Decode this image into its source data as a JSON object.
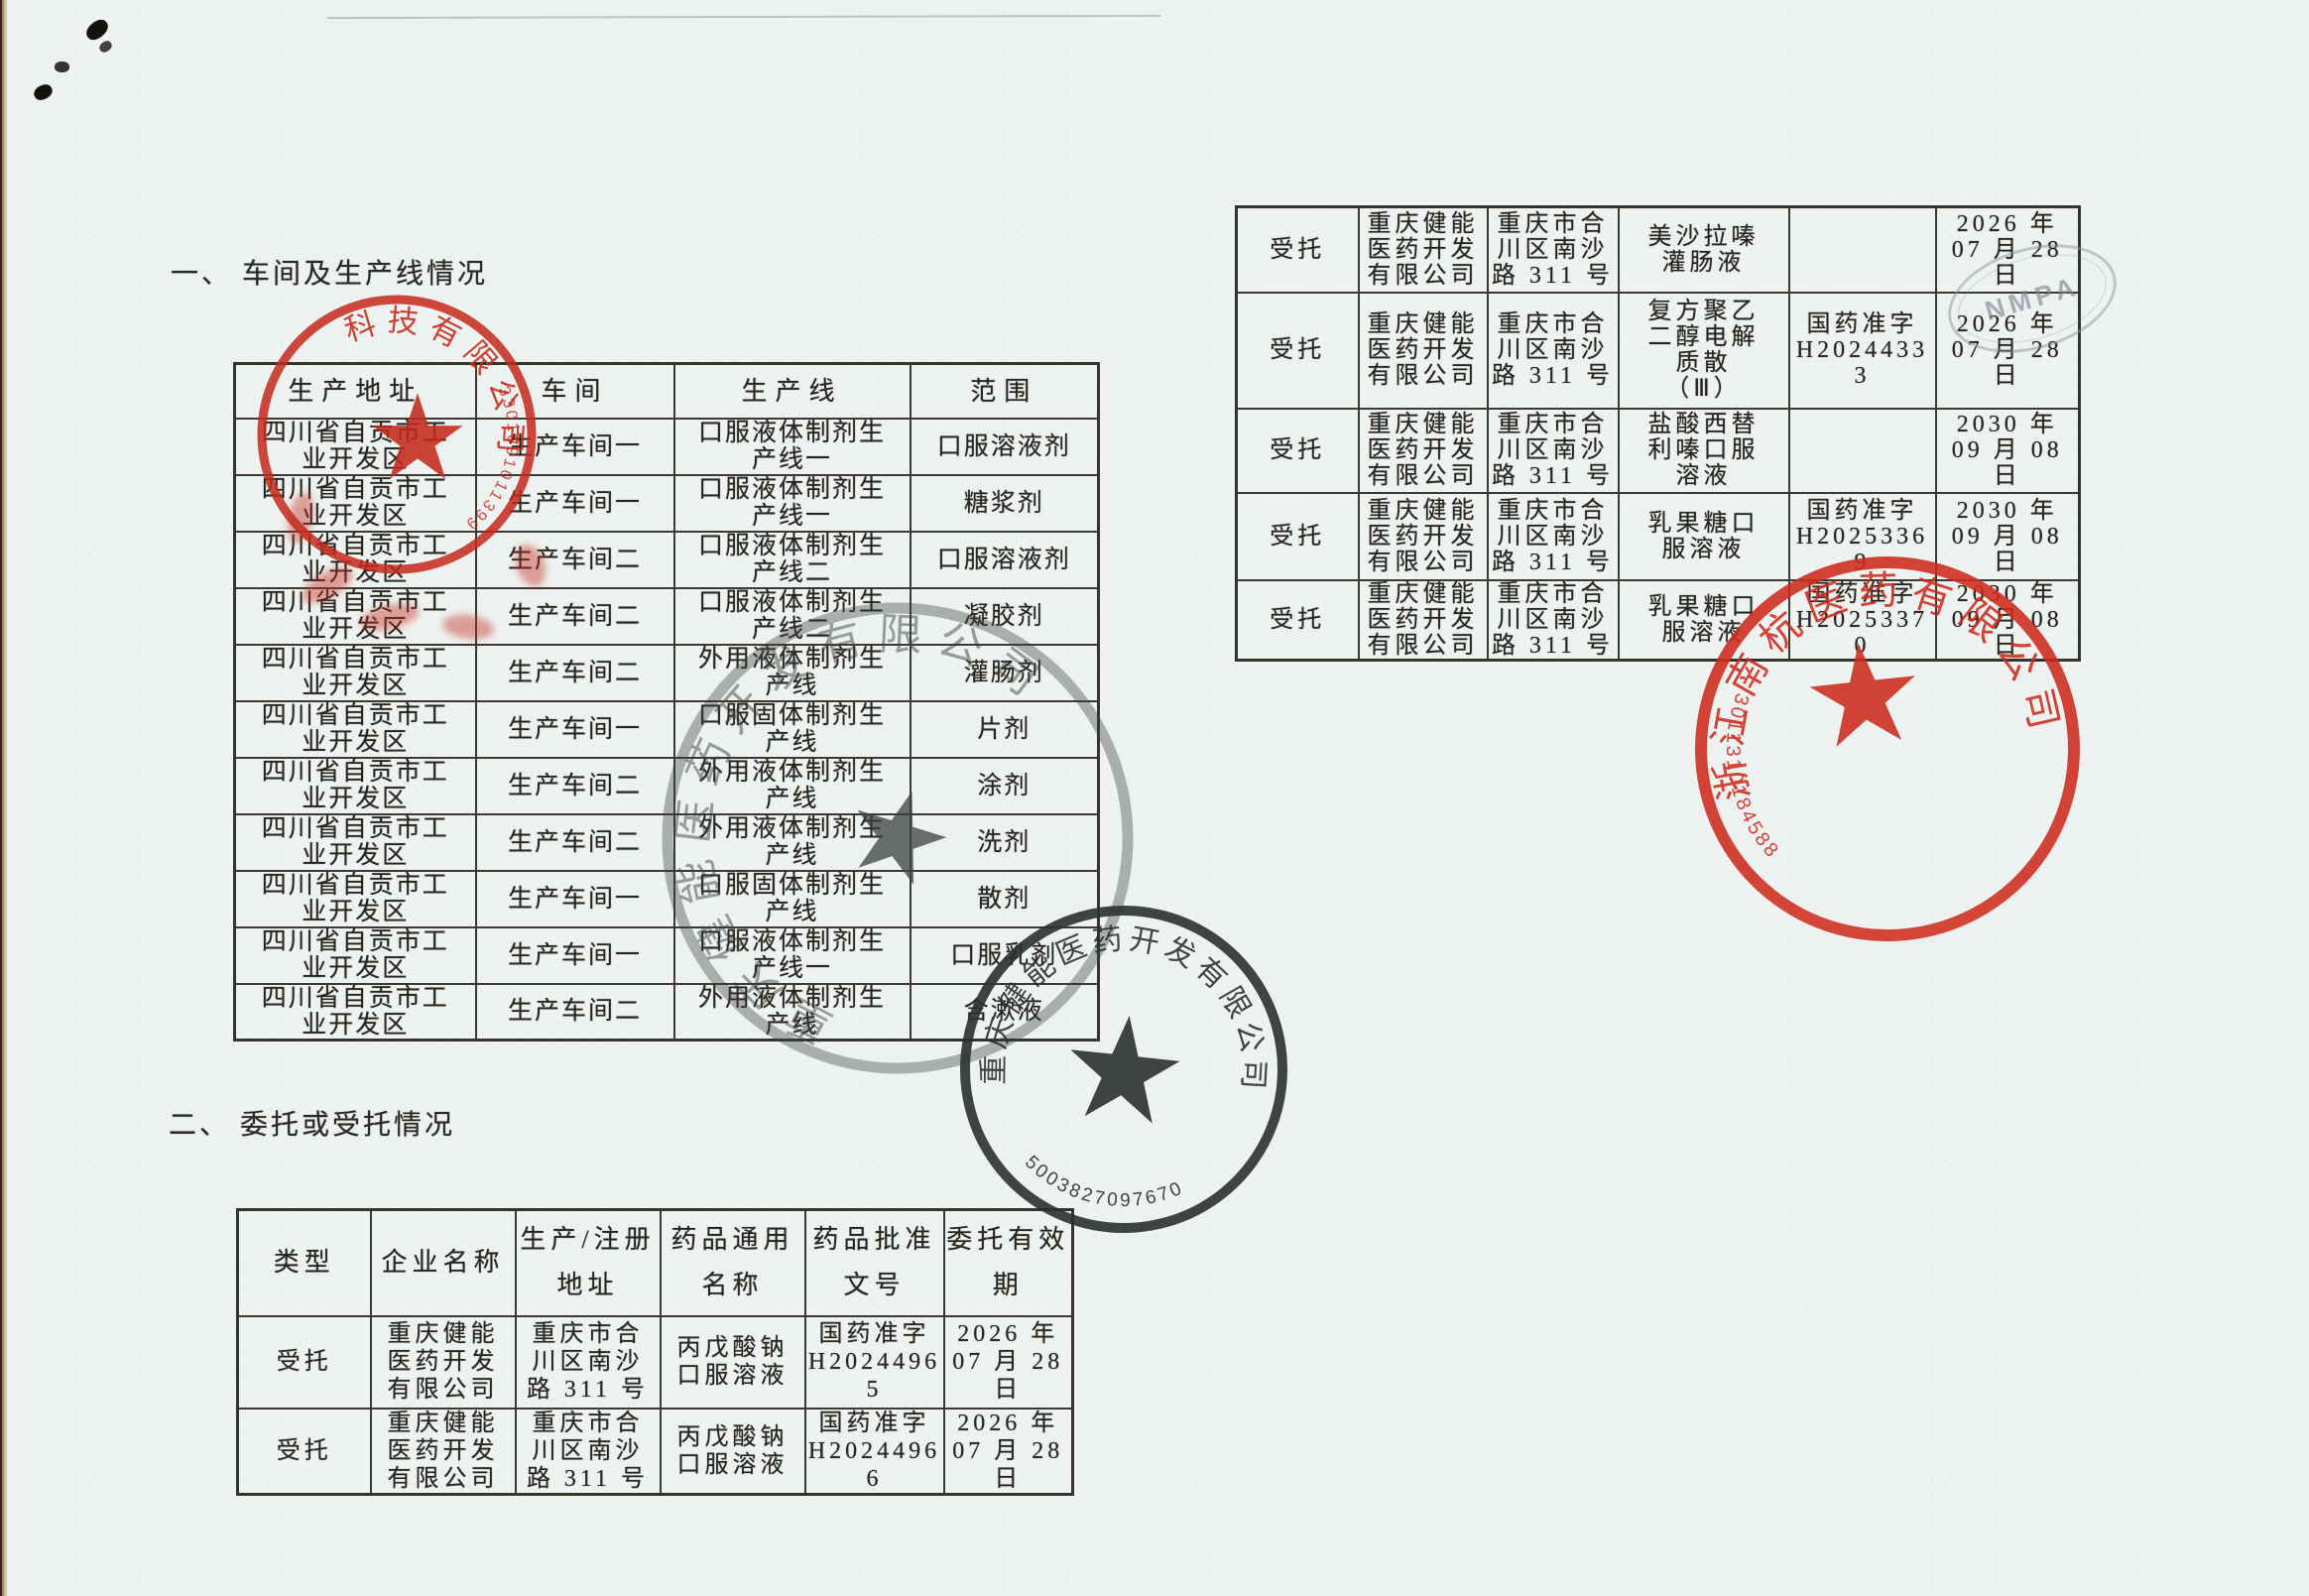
{
  "page": {
    "heading1": "一、 车间及生产线情况",
    "heading2": "二、 委托或受托情况"
  },
  "table1": {
    "headers": [
      "生产地址",
      "车间",
      "生产线",
      "范围"
    ],
    "rows": [
      [
        "四川省自贡市工\n业开发区",
        "生产车间一",
        "口服液体制剂生\n产线一",
        "口服溶液剂"
      ],
      [
        "四川省自贡市工\n业开发区",
        "生产车间一",
        "口服液体制剂生\n产线一",
        "糖浆剂"
      ],
      [
        "四川省自贡市工\n业开发区",
        "生产车间二",
        "口服液体制剂生\n产线二",
        "口服溶液剂"
      ],
      [
        "四川省自贡市工\n业开发区",
        "生产车间二",
        "口服液体制剂生\n产线二",
        "凝胶剂"
      ],
      [
        "四川省自贡市工\n业开发区",
        "生产车间二",
        "外用液体制剂生\n产线",
        "灌肠剂"
      ],
      [
        "四川省自贡市工\n业开发区",
        "生产车间一",
        "口服固体制剂生\n产线",
        "片剂"
      ],
      [
        "四川省自贡市工\n业开发区",
        "生产车间二",
        "外用液体制剂生\n产线",
        "涂剂"
      ],
      [
        "四川省自贡市工\n业开发区",
        "生产车间二",
        "外用液体制剂生\n产线",
        "洗剂"
      ],
      [
        "四川省自贡市工\n业开发区",
        "生产车间一",
        "口服固体制剂生\n产线",
        "散剂"
      ],
      [
        "四川省自贡市工\n业开发区",
        "生产车间一",
        "口服液体制剂生\n产线一",
        "口服乳剂"
      ],
      [
        "四川省自贡市工\n业开发区",
        "生产车间二",
        "外用液体制剂生\n产线",
        "含漱液"
      ]
    ]
  },
  "table2": {
    "headers": [
      "类型",
      "企业名称",
      "生产/注册\n地址",
      "药品通用\n名称",
      "药品批准\n文号",
      "委托有效\n期"
    ],
    "rows": [
      [
        "受托",
        "重庆健能\n医药开发\n有限公司",
        "重庆市合\n川区南沙\n路 311 号",
        "丙戊酸钠\n口服溶液",
        "国药准字\nH2024496\n5",
        "2026 年\n07 月 28\n日"
      ],
      [
        "受托",
        "重庆健能\n医药开发\n有限公司",
        "重庆市合\n川区南沙\n路 311 号",
        "丙戊酸钠\n口服溶液",
        "国药准字\nH2024496\n6",
        "2026 年\n07 月 28\n日"
      ]
    ]
  },
  "table3": {
    "rows": [
      [
        "受托",
        "重庆健能\n医药开发\n有限公司",
        "重庆市合\n川区南沙\n路 311 号",
        "美沙拉嗪\n灌肠液",
        "",
        "2026 年\n07 月 28\n日"
      ],
      [
        "受托",
        "重庆健能\n医药开发\n有限公司",
        "重庆市合\n川区南沙\n路 311 号",
        "复方聚乙\n二醇电解\n质散\n（Ⅲ）",
        "国药准字\nH2024433\n3",
        "2026 年\n07 月 28\n日"
      ],
      [
        "受托",
        "重庆健能\n医药开发\n有限公司",
        "重庆市合\n川区南沙\n路 311 号",
        "盐酸西替\n利嗪口服\n溶液",
        "",
        "2030 年\n09 月 08\n日"
      ],
      [
        "受托",
        "重庆健能\n医药开发\n有限公司",
        "重庆市合\n川区南沙\n路 311 号",
        "乳果糖口\n服溶液",
        "国药准字\nH2025336\n9",
        "2030 年\n09 月 08\n日"
      ],
      [
        "受托",
        "重庆健能\n医药开发\n有限公司",
        "重庆市合\n川区南沙\n路 311 号",
        "乳果糖口\n服溶液",
        "国药准字\nH2025337\n0",
        "2030 年\n09 月 08\n日"
      ]
    ]
  },
  "stamps": {
    "red_left": {
      "arc_text": "科技有限公司",
      "serial": "3301091011399",
      "color": "#c4291b"
    },
    "dark_overlap": {
      "arc_text": "重庆健能医药开发有限公司",
      "color": "#3c403d"
    },
    "dark_main": {
      "arc_text": "重庆健能医药开发有限公司",
      "serial": "5003827097670",
      "color": "#2d312f"
    },
    "red_right": {
      "arc_text": "浙江南杭医药有限公司",
      "serial": "3011310184588",
      "color": "#cf2a1c"
    },
    "ghost_oval": {
      "text": "NMPA"
    }
  }
}
